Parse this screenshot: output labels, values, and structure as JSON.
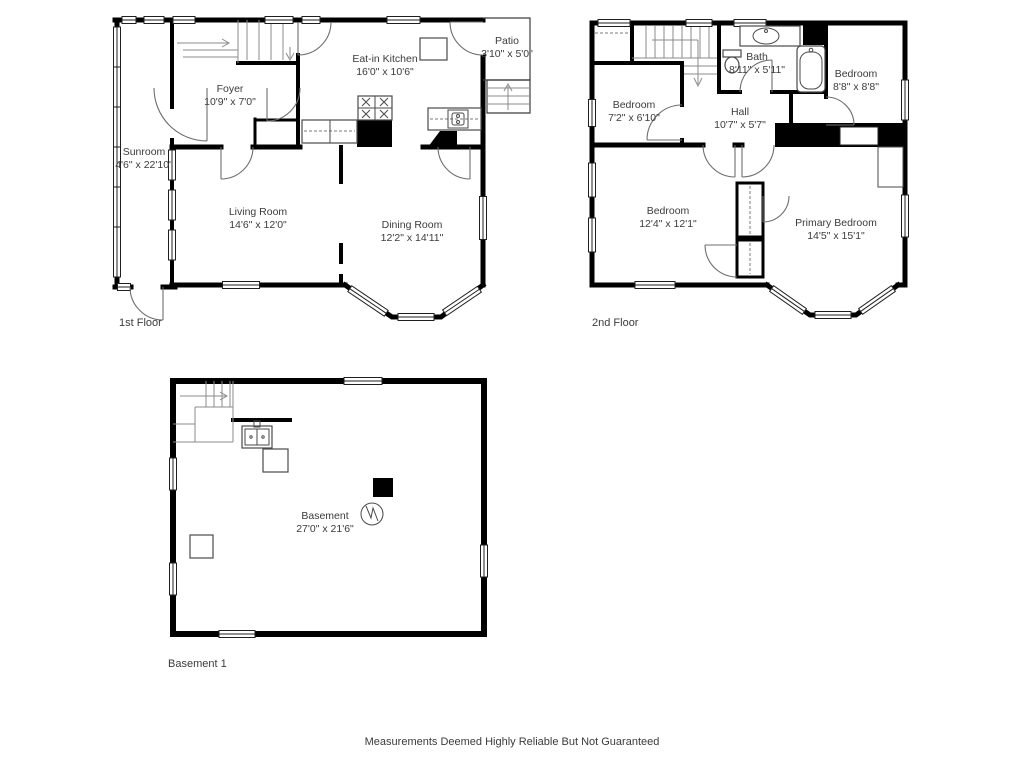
{
  "disclaimer": "Measurements Deemed Highly Reliable But Not Guaranteed",
  "floors": {
    "first": {
      "label": "1st Floor",
      "rooms": {
        "sunroom": {
          "name": "Sunroom",
          "dims": "4'6\" x 22'10\""
        },
        "foyer": {
          "name": "Foyer",
          "dims": "10'9\" x 7'0\""
        },
        "kitchen": {
          "name": "Eat-in Kitchen",
          "dims": "16'0\" x 10'6\""
        },
        "patio": {
          "name": "Patio",
          "dims": "3'10\" x 5'0\""
        },
        "living": {
          "name": "Living Room",
          "dims": "14'6\" x 12'0\""
        },
        "dining": {
          "name": "Dining Room",
          "dims": "12'2\" x 14'11\""
        }
      }
    },
    "second": {
      "label": "2nd Floor",
      "rooms": {
        "bedroom_small": {
          "name": "Bedroom",
          "dims": "7'2\" x 6'10\""
        },
        "bath": {
          "name": "Bath",
          "dims": "8'11\" x 5'11\""
        },
        "bedroom_corner": {
          "name": "Bedroom",
          "dims": "8'8\" x 8'8\""
        },
        "hall": {
          "name": "Hall",
          "dims": "10'7\" x 5'7\""
        },
        "bedroom_left": {
          "name": "Bedroom",
          "dims": "12'4\" x 12'1\""
        },
        "primary": {
          "name": "Primary Bedroom",
          "dims": "14'5\" x 15'1\""
        }
      }
    },
    "basement": {
      "label": "Basement 1",
      "rooms": {
        "basement": {
          "name": "Basement",
          "dims": "27'0\" x 21'6\""
        }
      }
    }
  }
}
